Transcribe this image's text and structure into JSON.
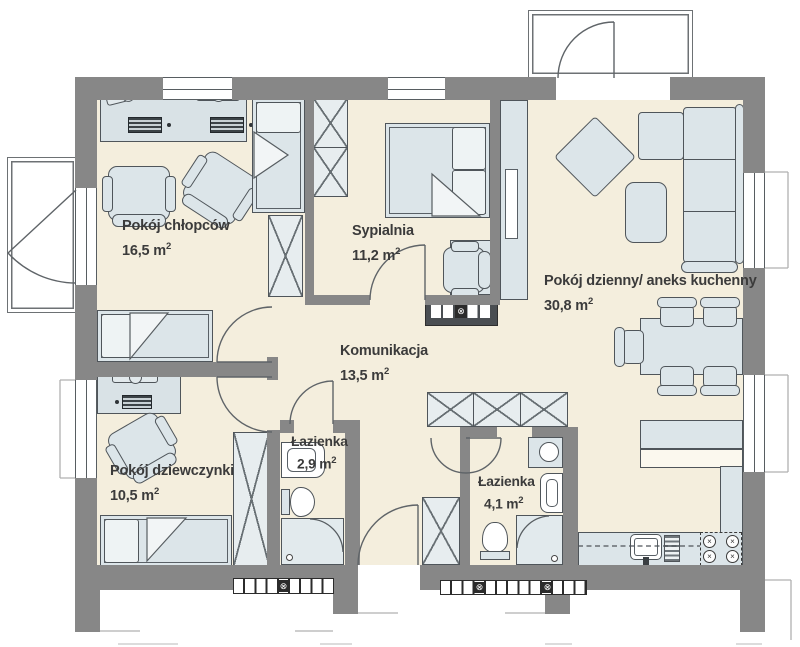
{
  "plan": {
    "rooms": [
      {
        "id": "boys",
        "name": "Pokój chłopców",
        "area": "16,5 m"
      },
      {
        "id": "bedroom",
        "name": "Sypialnia",
        "area": "11,2 m"
      },
      {
        "id": "living",
        "name": "Pokój dzienny/ aneks kuchenny",
        "area": "30,8 m"
      },
      {
        "id": "hall",
        "name": "Komunikacja",
        "area": "13,5 m"
      },
      {
        "id": "bath-small",
        "name": "Łazienka",
        "area": "2,9 m"
      },
      {
        "id": "bath-large",
        "name": "Łazienka",
        "area": "4,1 m"
      },
      {
        "id": "girls",
        "name": "Pokój dziewczynki",
        "area": "10,5 m"
      }
    ],
    "area_sup": "2",
    "symbols": {
      "valve": "⊗",
      "burner_mark": "×"
    },
    "colors": {
      "wall": "#878787",
      "floor": "#f4eedd",
      "furniture": "#dce5e9",
      "outline": "#4f555a",
      "text": "#3b3b3b"
    }
  }
}
